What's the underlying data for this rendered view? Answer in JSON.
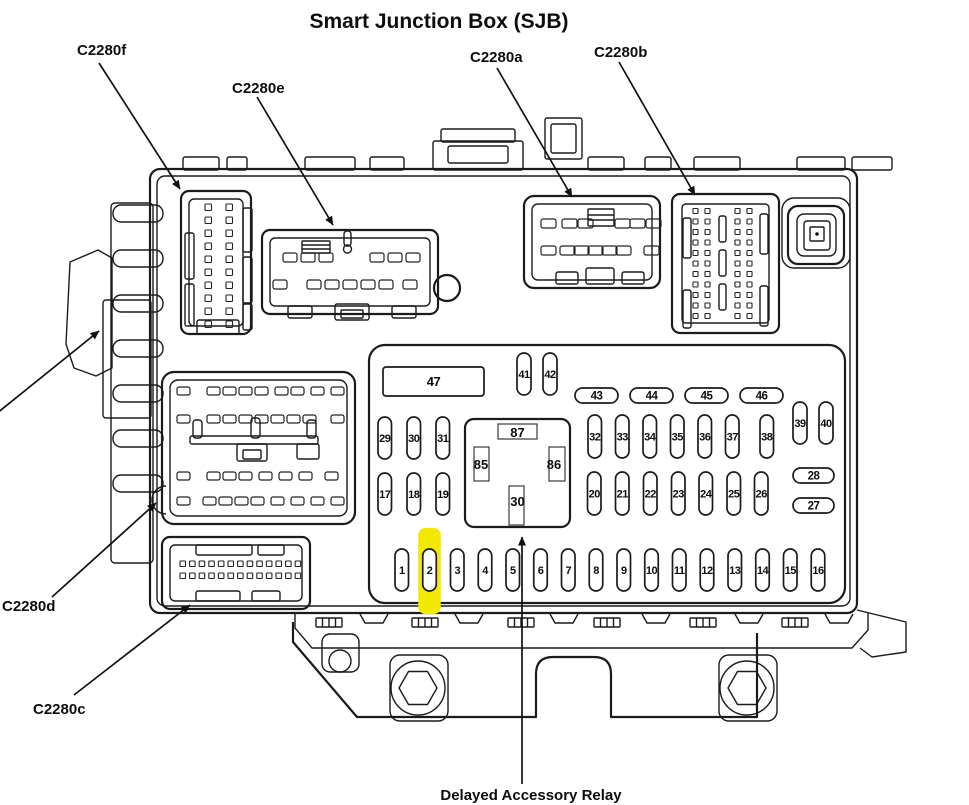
{
  "title": "Smart Junction Box (SJB)",
  "connector_labels": {
    "c2280f": "C2280f",
    "c2280e": "C2280e",
    "c2280a": "C2280a",
    "c2280b": "C2280b",
    "c2280d": "C2280d",
    "c2280c": "C2280c"
  },
  "callout": "Delayed Accessory Relay",
  "relay": {
    "top": "87",
    "left": "85",
    "right": "86",
    "bottom": "30"
  },
  "fuse_panel": {
    "highlighted_fuse": "2",
    "highlight_color": "#f2e900",
    "groups": {
      "fuse_47": [
        "47"
      ],
      "fuses_41_42": [
        "41",
        "42"
      ],
      "fuses_43_46": [
        "43",
        "44",
        "45",
        "46"
      ],
      "fuses_29_31": [
        "29",
        "30",
        "31"
      ],
      "fuses_17_19": [
        "17",
        "18",
        "19"
      ],
      "fuses_32_38": [
        "32",
        "33",
        "34",
        "35",
        "36",
        "37",
        "38"
      ],
      "fuses_39_40": [
        "39",
        "40"
      ],
      "fuses_20_26": [
        "20",
        "21",
        "22",
        "23",
        "24",
        "25",
        "26"
      ],
      "fuses_28_27": [
        "28",
        "27"
      ],
      "fuses_1_16": [
        "1",
        "2",
        "3",
        "4",
        "5",
        "6",
        "7",
        "8",
        "9",
        "10",
        "11",
        "12",
        "13",
        "14",
        "15",
        "16"
      ]
    }
  },
  "line_color": "#1b1b1b"
}
